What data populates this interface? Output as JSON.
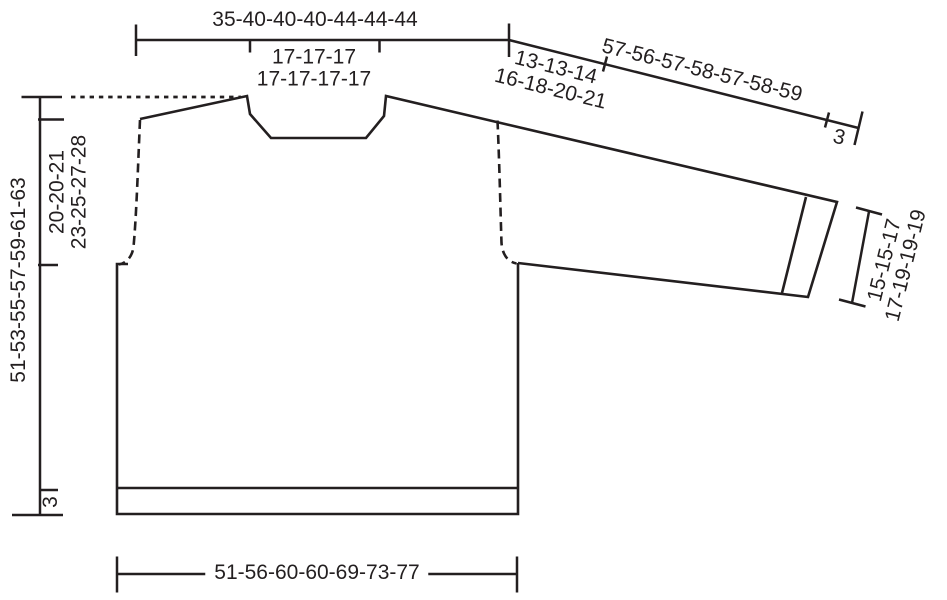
{
  "diagram": {
    "type": "garment-schematic",
    "subject": "sweater with drop shoulders and one sleeve, cm measurements for 7 sizes",
    "colors": {
      "line": "#231f20",
      "background": "#ffffff"
    },
    "labels": {
      "top_width": "35-40-40-40-44-44-44",
      "neck_width": [
        "17-17-17",
        "17-17-17-17"
      ],
      "shoulder_depth": [
        "13-13-14",
        "16-18-20-21"
      ],
      "sleeve_length": "57-56-57-58-57-58-59",
      "cuff_rib": "3",
      "cuff_width": [
        "15-15-17",
        "17-19-19-19"
      ],
      "yoke_depth": [
        "20-20-21",
        "23-25-27-28"
      ],
      "total_length": "51-53-55-57-59-61-63",
      "hem_rib": "3",
      "bottom_width": "51-56-60-60-69-73-77"
    }
  }
}
